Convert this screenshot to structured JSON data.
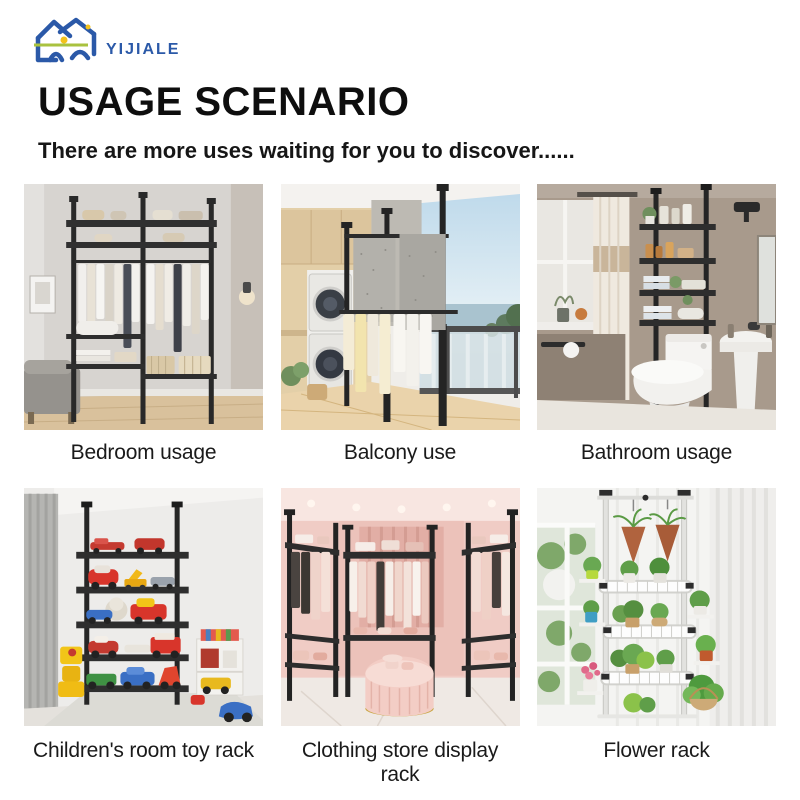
{
  "logo": {
    "text": "YIJIALE",
    "brand_blue": "#2b59a8",
    "accent_yellow": "#f3c21b",
    "accent_green": "#a9c23f",
    "icon": "house-logo-icon"
  },
  "header": {
    "title": "USAGE SCENARIO",
    "subtitle": "There are more uses waiting for you to discover......"
  },
  "cards": [
    {
      "label": "Bedroom usage",
      "scene": "bedroom"
    },
    {
      "label": "Balcony use",
      "scene": "balcony"
    },
    {
      "label": "Bathroom usage",
      "scene": "bathroom"
    },
    {
      "label": "Children's room toy rack",
      "scene": "children-room"
    },
    {
      "label": "Clothing store display rack",
      "scene": "clothing-store"
    },
    {
      "label": "Flower rack",
      "scene": "flower-rack"
    }
  ]
}
